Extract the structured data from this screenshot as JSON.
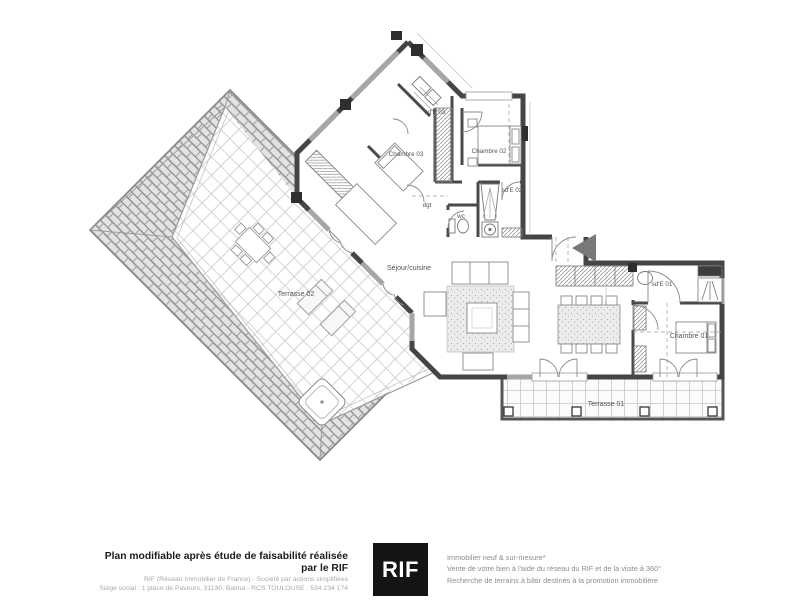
{
  "plan": {
    "rooms": [
      {
        "name": "sd'E 03"
      },
      {
        "name": "Chambre 03"
      },
      {
        "name": "Chambre 02"
      },
      {
        "name": "sd'E 02"
      },
      {
        "name": "dgt"
      },
      {
        "name": "wc"
      },
      {
        "name": "Séjour/cuisine"
      },
      {
        "name": "Terrasse 02"
      },
      {
        "name": "sd'E 01"
      },
      {
        "name": "Chambre 01"
      },
      {
        "name": "Terrasse 01"
      }
    ]
  },
  "footer": {
    "left": {
      "headline": "Plan modifiable après étude de faisabilité réalisée par le RIF",
      "line2": "RIF (Réseau Immobilier de France) - Société par actions simplifiées",
      "line3": "Siège social : 1 place de Paveurs, 31130, Balma - RCS TOULOUSE : 534 234 174"
    },
    "logo": {
      "text": "RIF"
    },
    "right": {
      "line1": "Immobilier neuf & sur-mesure*",
      "line2": "Vente de votre bien à l'aide du réseau du RIF et de la visite à 360°",
      "line3": "Recherche de terrains à bâtir destinés à la promotion immobilière"
    }
  },
  "colors": {
    "wall": "#454545",
    "window_band": "#a6a6a6",
    "roof_line": "#8f8f8f",
    "logo_bg": "#141414"
  }
}
